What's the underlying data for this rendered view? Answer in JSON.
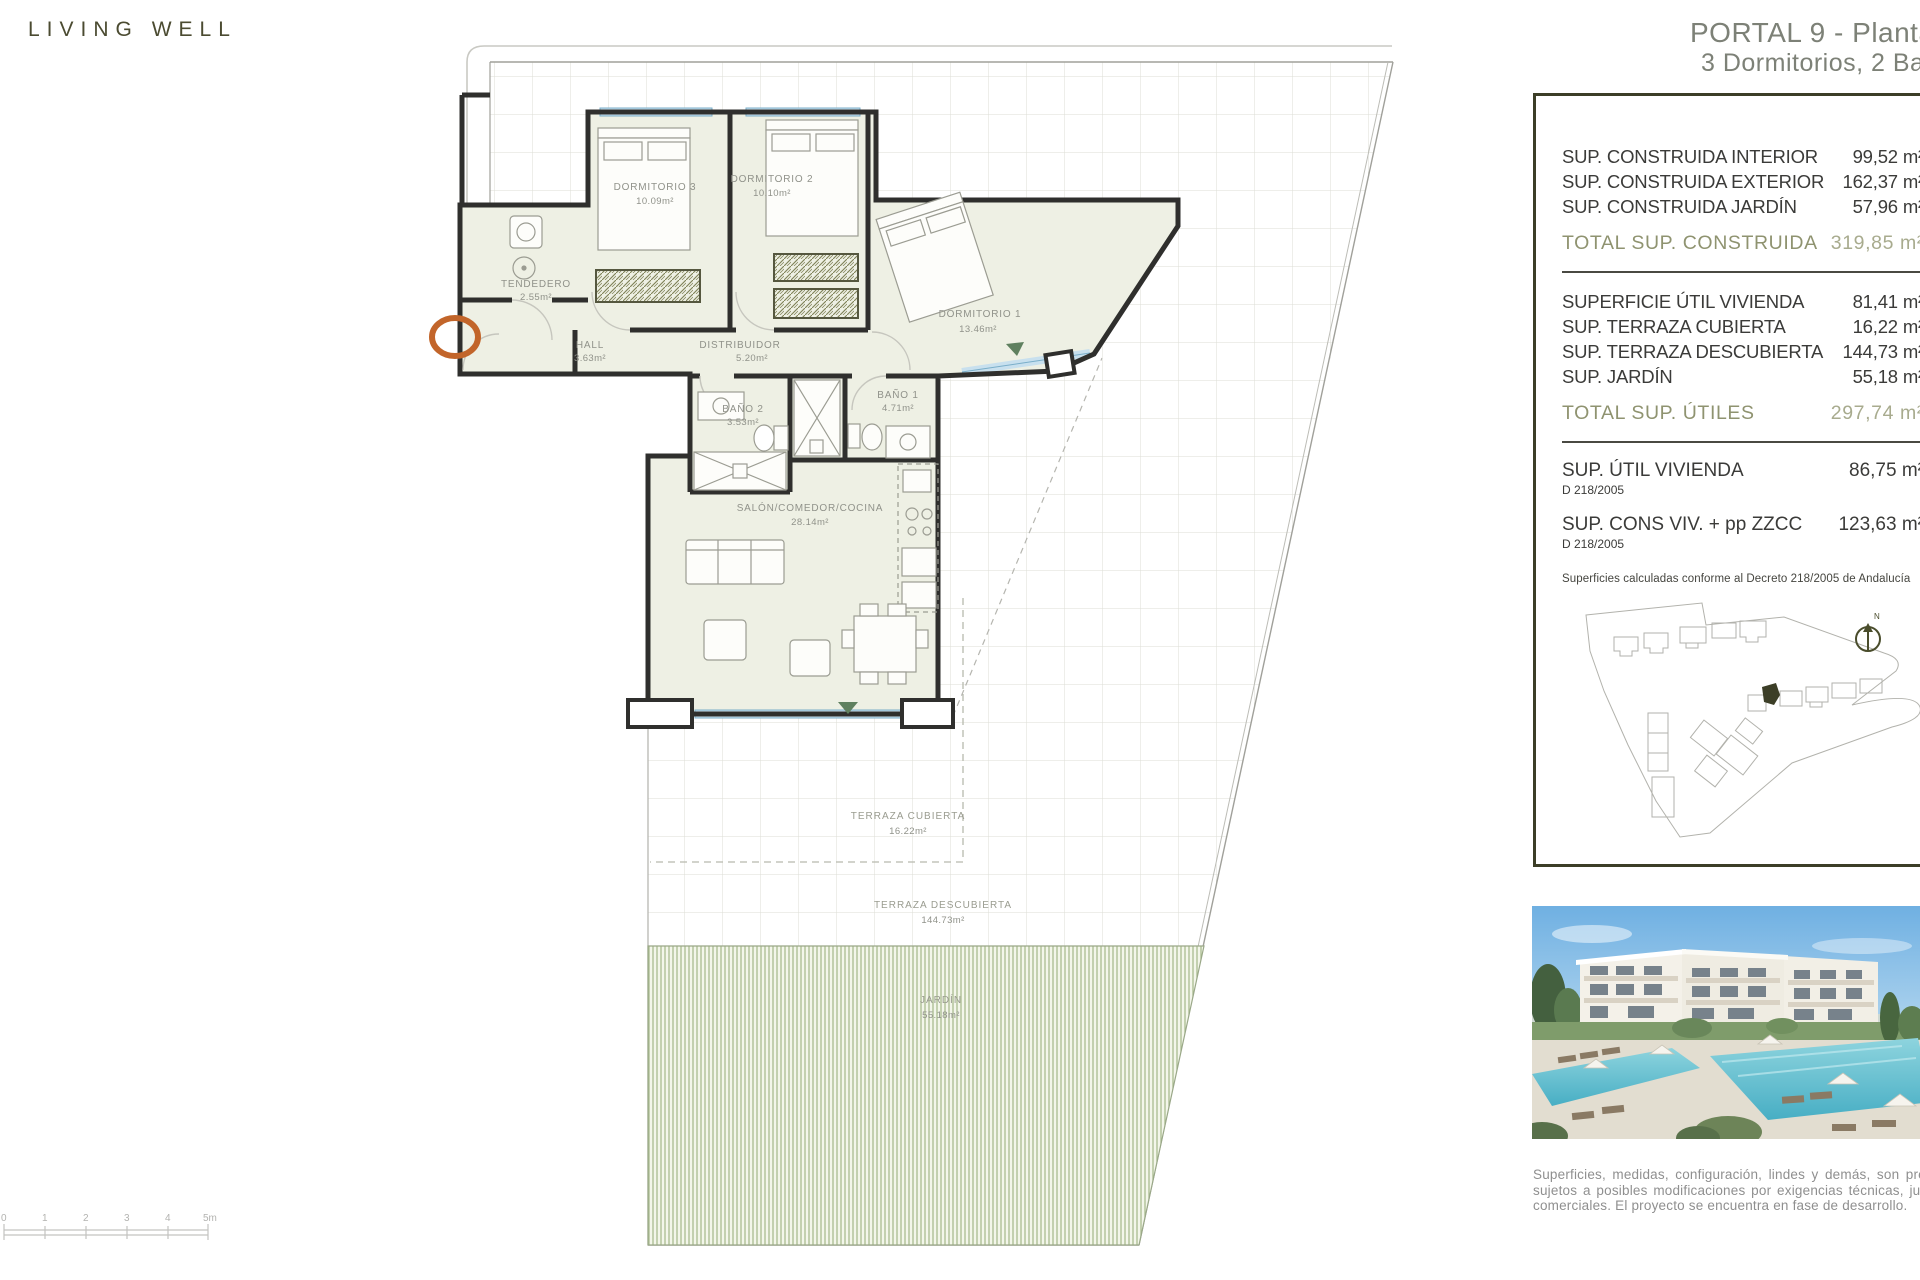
{
  "brand": {
    "logo_text": "LIVING WELL"
  },
  "title": {
    "line1": "PORTAL 9 - Planta Baja",
    "line2": "3 Dormitorios, 2 Baños"
  },
  "panel": {
    "built": {
      "rows": [
        {
          "label": "SUP. CONSTRUIDA INTERIOR",
          "value": "99,52 m²"
        },
        {
          "label": "SUP. CONSTRUIDA EXTERIOR",
          "value": "162,37 m²"
        },
        {
          "label": "SUP. CONSTRUIDA JARDÍN",
          "value": "57,96 m²"
        }
      ],
      "total": {
        "label": "TOTAL SUP. CONSTRUIDA",
        "value": "319,85 m²"
      }
    },
    "useful": {
      "rows": [
        {
          "label": "SUPERFICIE ÚTIL VIVIENDA",
          "value": "81,41 m²"
        },
        {
          "label": "SUP. TERRAZA CUBIERTA",
          "value": "16,22 m²"
        },
        {
          "label": "SUP. TERRAZA DESCUBIERTA",
          "value": "144,73 m²"
        },
        {
          "label": "SUP. JARDÍN",
          "value": "55,18 m²"
        }
      ],
      "total": {
        "label": "TOTAL SUP. ÚTILES",
        "value": "297,74 m²"
      }
    },
    "decree": {
      "rows": [
        {
          "label": "SUP. ÚTIL VIVIENDA",
          "value": "86,75 m²",
          "sub": "D 218/2005"
        },
        {
          "label": "SUP. CONS VIV. + pp ZZCC",
          "value": "123,63 m²",
          "sub": "D 218/2005"
        }
      ],
      "note": "Superficies calculadas conforme al Decreto 218/2005 de Andalucía"
    },
    "site_plan": {
      "north_label": "N"
    }
  },
  "plan": {
    "rooms": {
      "dorm3": {
        "name": "DORMITORIO 3",
        "area": "10.09m²"
      },
      "dorm2": {
        "name": "DORMITORIO 2",
        "area": "10.10m²"
      },
      "dorm1": {
        "name": "DORMITORIO 1",
        "area": "13.46m²"
      },
      "tendedero": {
        "name": "TENDEDERO",
        "area": "2.55m²"
      },
      "hall": {
        "name": "HALL",
        "area": "3.63m²"
      },
      "distribuidor": {
        "name": "DISTRIBUIDOR",
        "area": "5.20m²"
      },
      "bano2": {
        "name": "BAÑO 2",
        "area": "3.53m²"
      },
      "bano1": {
        "name": "BAÑO 1",
        "area": "4.71m²"
      },
      "salon": {
        "name": "SALÓN/COMEDOR/COCINA",
        "area": "28.14m²"
      },
      "terraza_cubierta": {
        "name": "TERRAZA CUBIERTA",
        "area": "16.22m²"
      },
      "terraza_descubierta": {
        "name": "TERRAZA DESCUBIERTA",
        "area": "144.73m²"
      },
      "jardin": {
        "name": "JARDÍN",
        "area": "55.18m²"
      }
    }
  },
  "scale_bar": {
    "labels": [
      "0",
      "1",
      "2",
      "3",
      "4",
      "5m"
    ]
  },
  "disclaimer": "Superficies, medidas, configuración, lindes y demás, son previstos y sujetos a posibles modificaciones por exigencias técnicas, jurídicas o comerciales. El proyecto se encuentra en fase de desarrollo.",
  "colors": {
    "accent_olive": "#3c3e27",
    "total_olive": "#8f9370",
    "title_gray": "#7d8177",
    "entry_orange": "#c2652a",
    "window_blue": "#c8e0ee",
    "garden_green": "#a9bb8f",
    "pool_turquoise": "#58b7c8"
  }
}
